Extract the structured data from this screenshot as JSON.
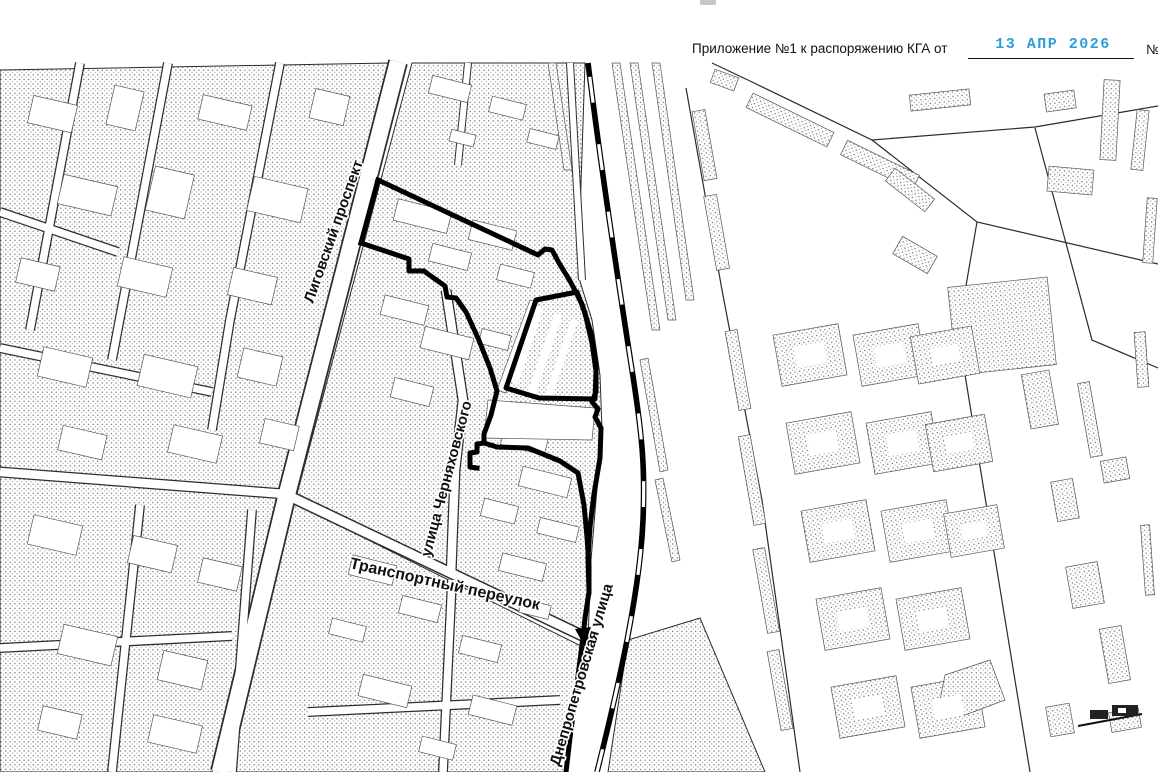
{
  "header": {
    "label": "Приложение №1 к распоряжению КГА от",
    "stamp_date": "13 АПР 2026",
    "number_sign": "№",
    "stamp_color": "#2e9fd6"
  },
  "map": {
    "street_labels": {
      "ligovsky": "Лиговский проспект",
      "chernyakhovskogo": "улица Черняховского",
      "transportny": "Транспортный переулок",
      "dnepropetrovskaya": "Днепропетровская улица"
    },
    "colors": {
      "map_line": "#2a2a2a",
      "boundary": "#000000",
      "stipple_dot": "#707070"
    }
  }
}
